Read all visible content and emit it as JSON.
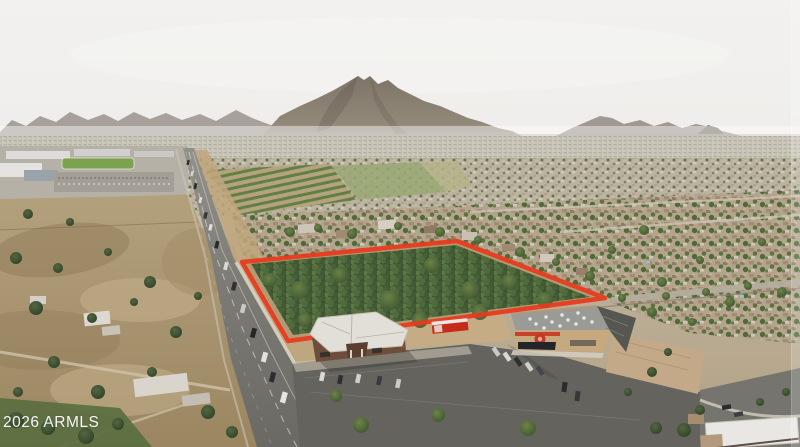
{
  "watermark": {
    "text": "2026 ARMLS"
  },
  "colors": {
    "sky": "#efeeec",
    "mountain_gray": "#867d72",
    "parcel_boundary_red": "#e8391d",
    "parcel_canopy_green": "#3c5230",
    "orchard_green": "#5d7a40",
    "road_asphalt": "#7b7a75",
    "dirt_tan": "#c0a67c",
    "store_roof_gray": "#9a9b97",
    "store_logo_red": "#c63626",
    "truck_red": "#c52a1a"
  }
}
